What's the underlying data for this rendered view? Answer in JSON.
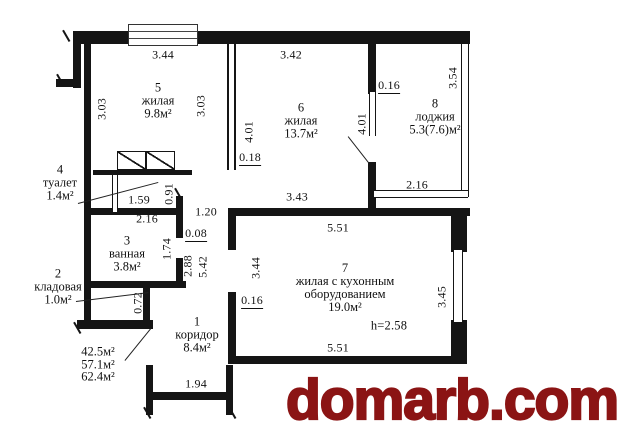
{
  "rooms": {
    "room5": {
      "number": "5",
      "name": "жилая",
      "area": "9.8м²"
    },
    "room6": {
      "number": "6",
      "name": "жилая",
      "area": "13.7м²"
    },
    "room8": {
      "number": "8",
      "name": "лоджия",
      "area": "5.3(7.6)м²"
    },
    "room4": {
      "number": "4",
      "name": "туалет",
      "area": "1.4м²"
    },
    "room3": {
      "number": "3",
      "name": "ванная",
      "area": "3.8м²"
    },
    "room2": {
      "number": "2",
      "name": "кладовая",
      "area": "1.0м²"
    },
    "room1": {
      "number": "1",
      "name": "коридор",
      "area": "8.4м²"
    },
    "room7": {
      "number": "7",
      "name_line1": "жилая с кухонным",
      "name_line2": "оборудованием",
      "area": "19.0м²",
      "ceiling_height": "h=2.58"
    }
  },
  "totals": {
    "line1": "42.5м²",
    "line2": "57.1м²",
    "line3": "62.4м²"
  },
  "dims": [
    "3.44",
    "3.42",
    "3.54",
    "0.16",
    "3.03",
    "3.03",
    "4.01",
    "4.01",
    "0.18",
    "2.16",
    "1.59",
    "0.91",
    "1.20",
    "2.16",
    "0.08",
    "1.74",
    "2.88",
    "5.42",
    "3.43",
    "5.51",
    "3.44",
    "0.16",
    "0.72",
    "3.45",
    "5.51",
    "1.94"
  ],
  "watermark": {
    "text": "domarb.com",
    "color": "#8b1414"
  }
}
